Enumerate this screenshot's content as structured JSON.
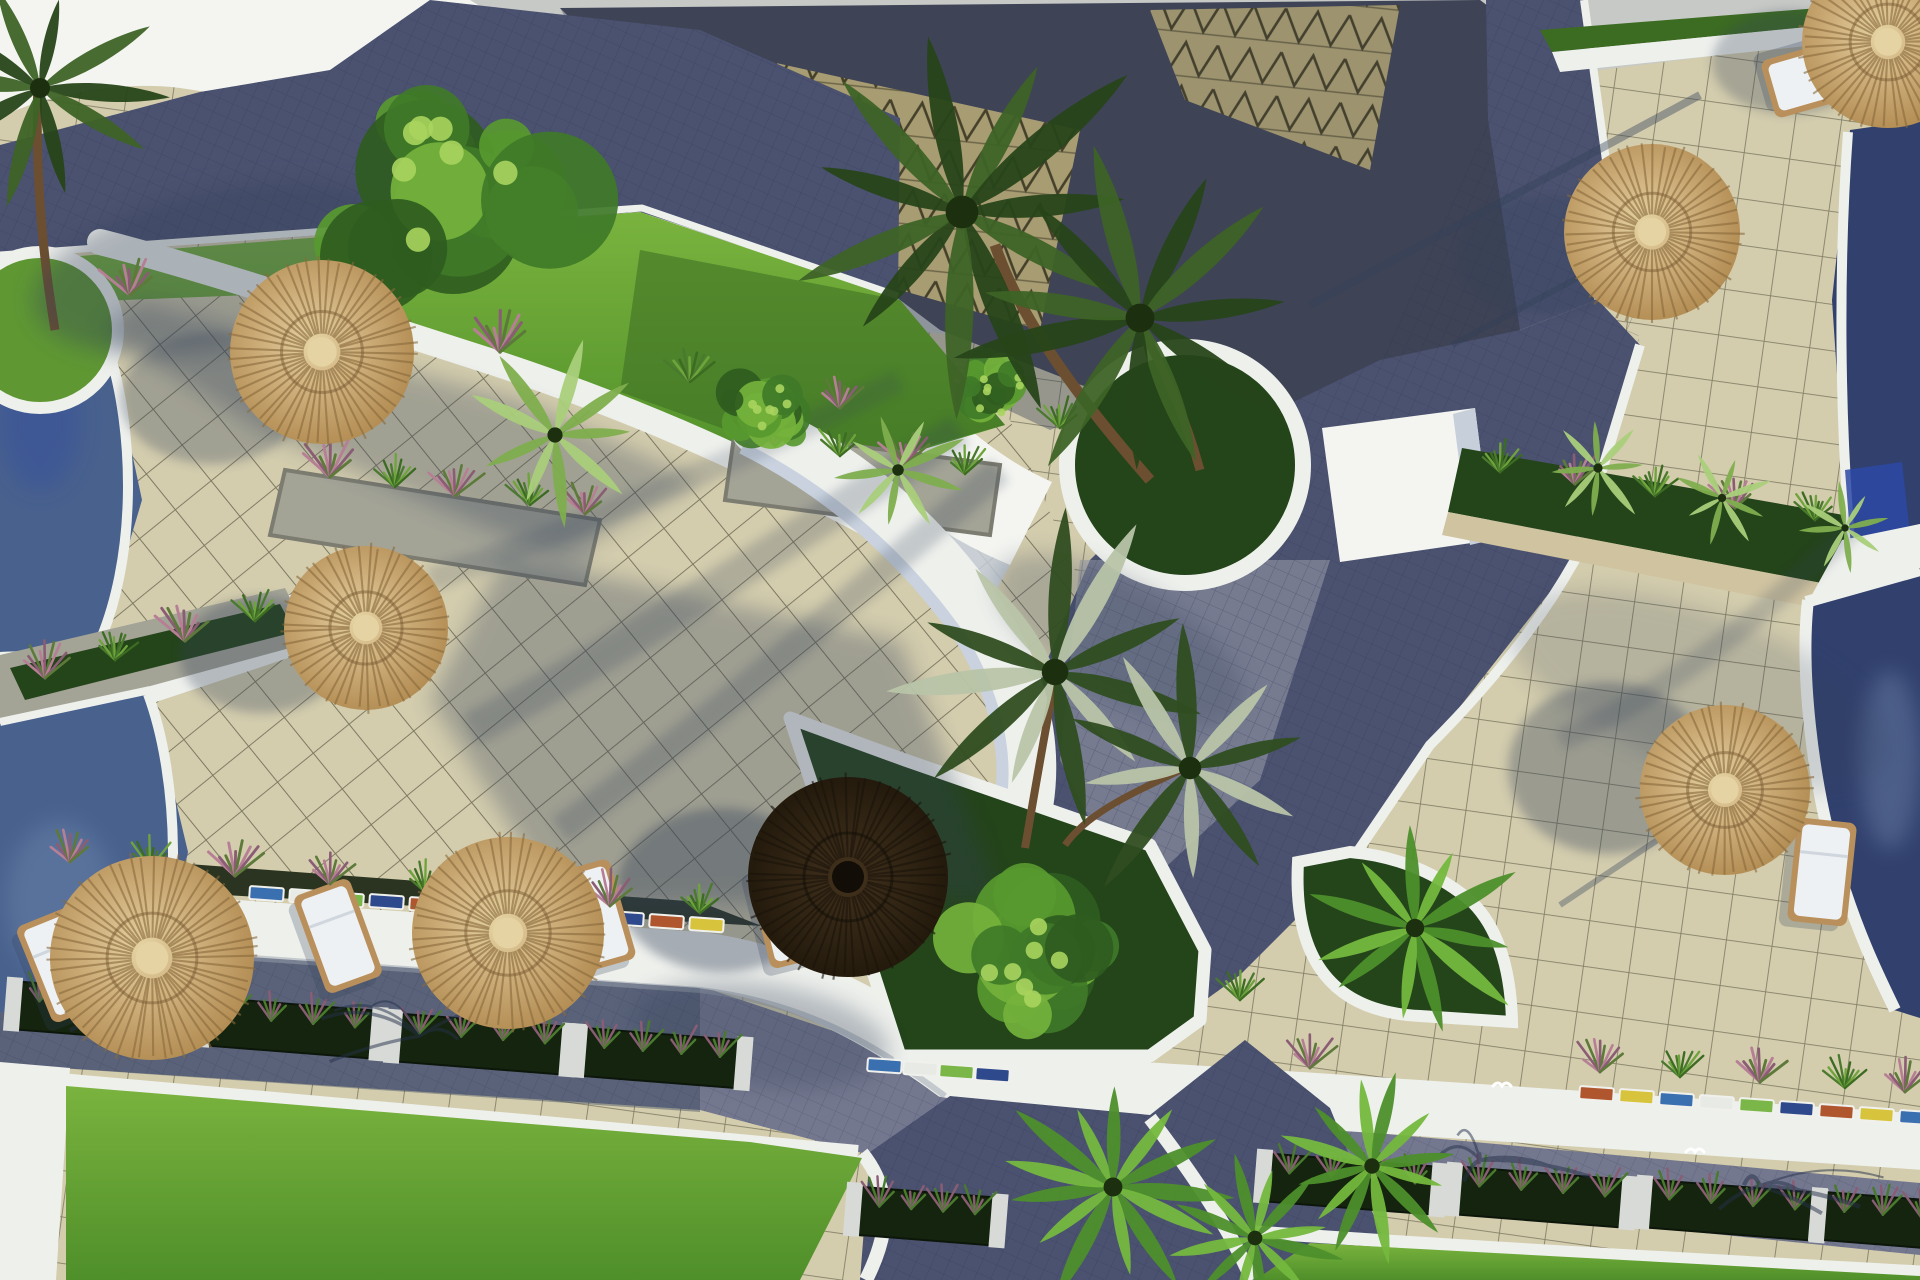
{
  "meta": {
    "title": "Aerial 3D render of resort villas",
    "description": "Top-down architectural rendering of a resort complex: beige tiled terraces with thatched straw umbrellas and white sun loungers, curved white sail roofs over triangular-tiled pavilions, palm trees in round and triangular white-curbed planters, blue swimming pools at the left and right edges, dark paver roads with white walkways, flower planter boxes and bright green lawns along the bottom."
  },
  "palette": {
    "bg_gray": "#c7c9c6",
    "white": "#f4f5f1",
    "white_shade": "#c7cfda",
    "curb_white": "#eef0ec",
    "roof_navy": "#3e4356",
    "road_navy": "#4b5270",
    "road_light": "#9b9cab",
    "road_violet": "#74788f",
    "tile_sun": "#d3ccad",
    "tile_line": "#6e6a54",
    "tri_khaki": "#a79c72",
    "tri_line": "#45402a",
    "lawn": "#5f9733",
    "lawn_bright": "#79b23e",
    "lawn_dark": "#3c6b22",
    "planter_green": "#24441a",
    "bush_green": "#3f7a28",
    "palm_dark": "#2a481d",
    "palm_light": "#74b83e",
    "palm_pale": "#a9cf7a",
    "trunk_brown": "#6b4f30",
    "stone": "#a3a396",
    "soil": "#2a3420",
    "sand": "#cfc3a0",
    "pool": "#48618d",
    "pool_deep": "#31406d",
    "pool_bright": "#2d49a4",
    "pool_ripple": "#8099bd",
    "umb_tan": "#c2a068",
    "umb_tan_light": "#e5d3a3",
    "umb_tan_dark": "#8a6a3c",
    "umb_dark": "#2c2113",
    "umb_dark_edge": "#1b140b",
    "flower_pink": "#b77f95",
    "shadow_col": "#324058"
  },
  "scene": {
    "umbrellas": [
      {
        "x": 322,
        "y": 352,
        "r": 92,
        "type": "tan"
      },
      {
        "x": 366,
        "y": 628,
        "r": 82,
        "type": "tan"
      },
      {
        "x": 152,
        "y": 958,
        "r": 102,
        "type": "tan"
      },
      {
        "x": 508,
        "y": 933,
        "r": 96,
        "type": "tan"
      },
      {
        "x": 848,
        "y": 877,
        "r": 100,
        "type": "dark"
      },
      {
        "x": 1652,
        "y": 232,
        "r": 88,
        "type": "tan"
      },
      {
        "x": 1725,
        "y": 790,
        "r": 85,
        "type": "tan"
      },
      {
        "x": 1888,
        "y": 42,
        "r": 86,
        "type": "tan"
      }
    ],
    "loungers": [
      {
        "x": 62,
        "y": 965,
        "rot": -22
      },
      {
        "x": 338,
        "y": 936,
        "rot": -20
      },
      {
        "x": 594,
        "y": 916,
        "rot": -16
      },
      {
        "x": 788,
        "y": 912,
        "rot": -14
      },
      {
        "x": 1822,
        "y": 872,
        "rot": 6
      },
      {
        "x": 1818,
        "y": 76,
        "rot": 74
      }
    ],
    "planter_boxes": [
      {
        "x": 100,
        "y": 1008,
        "w": 150
      },
      {
        "x": 290,
        "y": 1024,
        "w": 150
      },
      {
        "x": 480,
        "y": 1040,
        "w": 150
      },
      {
        "x": 660,
        "y": 1054,
        "w": 140
      },
      {
        "x": 925,
        "y": 1212,
        "w": 120
      },
      {
        "x": 1350,
        "y": 1180,
        "w": 150
      },
      {
        "x": 1540,
        "y": 1193,
        "w": 150
      },
      {
        "x": 1730,
        "y": 1206,
        "w": 150
      },
      {
        "x": 1900,
        "y": 1218,
        "w": 140
      }
    ],
    "mosaic": {
      "colors": [
        "#3a6fb0",
        "#e8eae6",
        "#7ab648",
        "#2f4a8c",
        "#b0562e",
        "#d8c43c"
      ],
      "segments": [
        {
          "x": 250,
          "y": 886
        },
        {
          "x": 290,
          "y": 889
        },
        {
          "x": 330,
          "y": 892
        },
        {
          "x": 370,
          "y": 894
        },
        {
          "x": 410,
          "y": 897
        },
        {
          "x": 450,
          "y": 900
        },
        {
          "x": 490,
          "y": 903
        },
        {
          "x": 530,
          "y": 906
        },
        {
          "x": 570,
          "y": 908
        },
        {
          "x": 610,
          "y": 911
        },
        {
          "x": 650,
          "y": 914
        },
        {
          "x": 690,
          "y": 917
        },
        {
          "x": 868,
          "y": 1058
        },
        {
          "x": 904,
          "y": 1061
        },
        {
          "x": 940,
          "y": 1064
        },
        {
          "x": 976,
          "y": 1067
        },
        {
          "x": 1580,
          "y": 1086
        },
        {
          "x": 1620,
          "y": 1089
        },
        {
          "x": 1660,
          "y": 1092
        },
        {
          "x": 1700,
          "y": 1095
        },
        {
          "x": 1740,
          "y": 1098
        },
        {
          "x": 1780,
          "y": 1101
        },
        {
          "x": 1820,
          "y": 1104
        },
        {
          "x": 1860,
          "y": 1107
        },
        {
          "x": 1900,
          "y": 1110
        }
      ]
    },
    "tufts": [
      {
        "x": 70,
        "y": 862,
        "s": 1,
        "c": "pink"
      },
      {
        "x": 150,
        "y": 868,
        "s": 0.9,
        "c": "green"
      },
      {
        "x": 235,
        "y": 876,
        "s": 1.1,
        "c": "pink"
      },
      {
        "x": 330,
        "y": 884,
        "s": 1,
        "c": "pink"
      },
      {
        "x": 425,
        "y": 892,
        "s": 0.9,
        "c": "green"
      },
      {
        "x": 515,
        "y": 899,
        "s": 1.1,
        "c": "pink"
      },
      {
        "x": 610,
        "y": 906,
        "s": 1,
        "c": "pink"
      },
      {
        "x": 700,
        "y": 913,
        "s": 0.9,
        "c": "green"
      },
      {
        "x": 130,
        "y": 295,
        "s": 1.1,
        "c": "pink"
      },
      {
        "x": 300,
        "y": 322,
        "s": 0.9,
        "c": "green"
      },
      {
        "x": 500,
        "y": 352,
        "s": 1.2,
        "c": "pink"
      },
      {
        "x": 690,
        "y": 382,
        "s": 1,
        "c": "green"
      },
      {
        "x": 840,
        "y": 408,
        "s": 1,
        "c": "pink"
      },
      {
        "x": 980,
        "y": 400,
        "s": 1.1,
        "c": "pink"
      },
      {
        "x": 1060,
        "y": 428,
        "s": 0.9,
        "c": "green"
      },
      {
        "x": 330,
        "y": 477,
        "s": 1.1,
        "c": "pink"
      },
      {
        "x": 395,
        "y": 487,
        "s": 0.9,
        "c": "green"
      },
      {
        "x": 455,
        "y": 496,
        "s": 1,
        "c": "pink"
      },
      {
        "x": 530,
        "y": 505,
        "s": 0.9,
        "c": "green"
      },
      {
        "x": 585,
        "y": 514,
        "s": 1,
        "c": "pink"
      },
      {
        "x": 775,
        "y": 446,
        "s": 1,
        "c": "pink"
      },
      {
        "x": 840,
        "y": 456,
        "s": 0.9,
        "c": "green"
      },
      {
        "x": 905,
        "y": 465,
        "s": 1,
        "c": "pink"
      },
      {
        "x": 965,
        "y": 474,
        "s": 0.9,
        "c": "green"
      },
      {
        "x": 45,
        "y": 678,
        "s": 1,
        "c": "pink"
      },
      {
        "x": 115,
        "y": 660,
        "s": 0.9,
        "c": "green"
      },
      {
        "x": 185,
        "y": 641,
        "s": 1.1,
        "c": "pink"
      },
      {
        "x": 255,
        "y": 621,
        "s": 0.9,
        "c": "green"
      },
      {
        "x": 1500,
        "y": 472,
        "s": 0.9,
        "c": "green"
      },
      {
        "x": 1575,
        "y": 484,
        "s": 1,
        "c": "pink"
      },
      {
        "x": 1655,
        "y": 496,
        "s": 0.9,
        "c": "green"
      },
      {
        "x": 1735,
        "y": 508,
        "s": 1,
        "c": "pink"
      },
      {
        "x": 1815,
        "y": 520,
        "s": 0.9,
        "c": "green"
      },
      {
        "x": 1600,
        "y": 1072,
        "s": 1,
        "c": "pink"
      },
      {
        "x": 1680,
        "y": 1077,
        "s": 0.9,
        "c": "green"
      },
      {
        "x": 1760,
        "y": 1082,
        "s": 1.1,
        "c": "pink"
      },
      {
        "x": 1845,
        "y": 1088,
        "s": 0.9,
        "c": "green"
      },
      {
        "x": 1905,
        "y": 1092,
        "s": 1,
        "c": "pink"
      },
      {
        "x": 1310,
        "y": 1068,
        "s": 1,
        "c": "pink"
      },
      {
        "x": 1240,
        "y": 1000,
        "s": 0.9,
        "c": "green"
      }
    ],
    "palms": [
      {
        "x": 962,
        "y": 212,
        "r": 205,
        "n": 11,
        "type": "dark",
        "rot": 0
      },
      {
        "x": 1140,
        "y": 318,
        "r": 180,
        "n": 11,
        "type": "dark",
        "rot": 30
      },
      {
        "x": 1055,
        "y": 672,
        "r": 165,
        "n": 11,
        "type": "mid",
        "rot": 10
      },
      {
        "x": 1190,
        "y": 768,
        "r": 140,
        "n": 10,
        "type": "mid",
        "rot": -15
      },
      {
        "x": 40,
        "y": 88,
        "r": 125,
        "n": 10,
        "type": "dark",
        "rot": 0
      },
      {
        "x": 1113,
        "y": 1187,
        "r": 118,
        "n": 13,
        "type": "fan",
        "rot": 0
      },
      {
        "x": 1255,
        "y": 1238,
        "r": 92,
        "n": 12,
        "type": "fan",
        "rot": 20
      },
      {
        "x": 1372,
        "y": 1166,
        "r": 96,
        "n": 12,
        "type": "fan",
        "rot": -10
      },
      {
        "x": 555,
        "y": 435,
        "r": 95,
        "n": 9,
        "type": "pale",
        "rot": 0
      },
      {
        "x": 898,
        "y": 470,
        "r": 72,
        "n": 9,
        "type": "pale",
        "rot": 15
      },
      {
        "x": 1598,
        "y": 468,
        "r": 58,
        "n": 8,
        "type": "pale",
        "rot": 0
      },
      {
        "x": 1722,
        "y": 498,
        "r": 52,
        "n": 8,
        "type": "pale",
        "rot": 20
      },
      {
        "x": 1845,
        "y": 528,
        "r": 46,
        "n": 8,
        "type": "pale",
        "rot": -10
      },
      {
        "x": 1415,
        "y": 928,
        "r": 115,
        "n": 11,
        "type": "fan",
        "rot": 5
      }
    ],
    "bushes": [
      {
        "x": 445,
        "y": 192,
        "r": 152
      },
      {
        "x": 1028,
        "y": 955,
        "r": 108
      },
      {
        "x": 768,
        "y": 415,
        "r": 56
      },
      {
        "x": 995,
        "y": 392,
        "r": 50
      }
    ],
    "birds": [
      {
        "x": 1502,
        "y": 1086
      },
      {
        "x": 1695,
        "y": 1152
      }
    ]
  }
}
